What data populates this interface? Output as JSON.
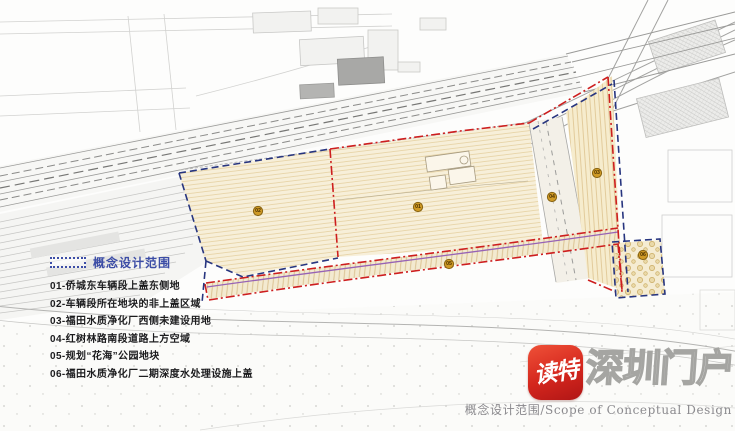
{
  "legend": {
    "title": "概念设计范围",
    "items": [
      "01-侨城东车辆段上盖东侧地",
      "02-车辆段所在地块的非上盖区域",
      "03-福田水质净化厂西侧未建设用地",
      "04-红树林路南段道路上方空域",
      "05-规划“花海”公园地块",
      "06-福田水质净化厂二期深度水处理设施上盖"
    ]
  },
  "map": {
    "markers": [
      {
        "label": "01"
      },
      {
        "label": "02"
      },
      {
        "label": "03"
      },
      {
        "label": "04"
      },
      {
        "label": "05"
      },
      {
        "label": "06"
      }
    ],
    "colors": {
      "site_fill": "#f7efd9",
      "site_hatch": "#e6d2a4",
      "boundary_red": "#cd1e1e",
      "boundary_blue": "#27357f",
      "band_purple": "#9763b5",
      "marker_fill": "#cf9a25"
    }
  },
  "watermark": {
    "app_name": "读特",
    "portal_text": "深圳门户"
  },
  "caption": "概念设计范围/Scope of Conceptual Design"
}
